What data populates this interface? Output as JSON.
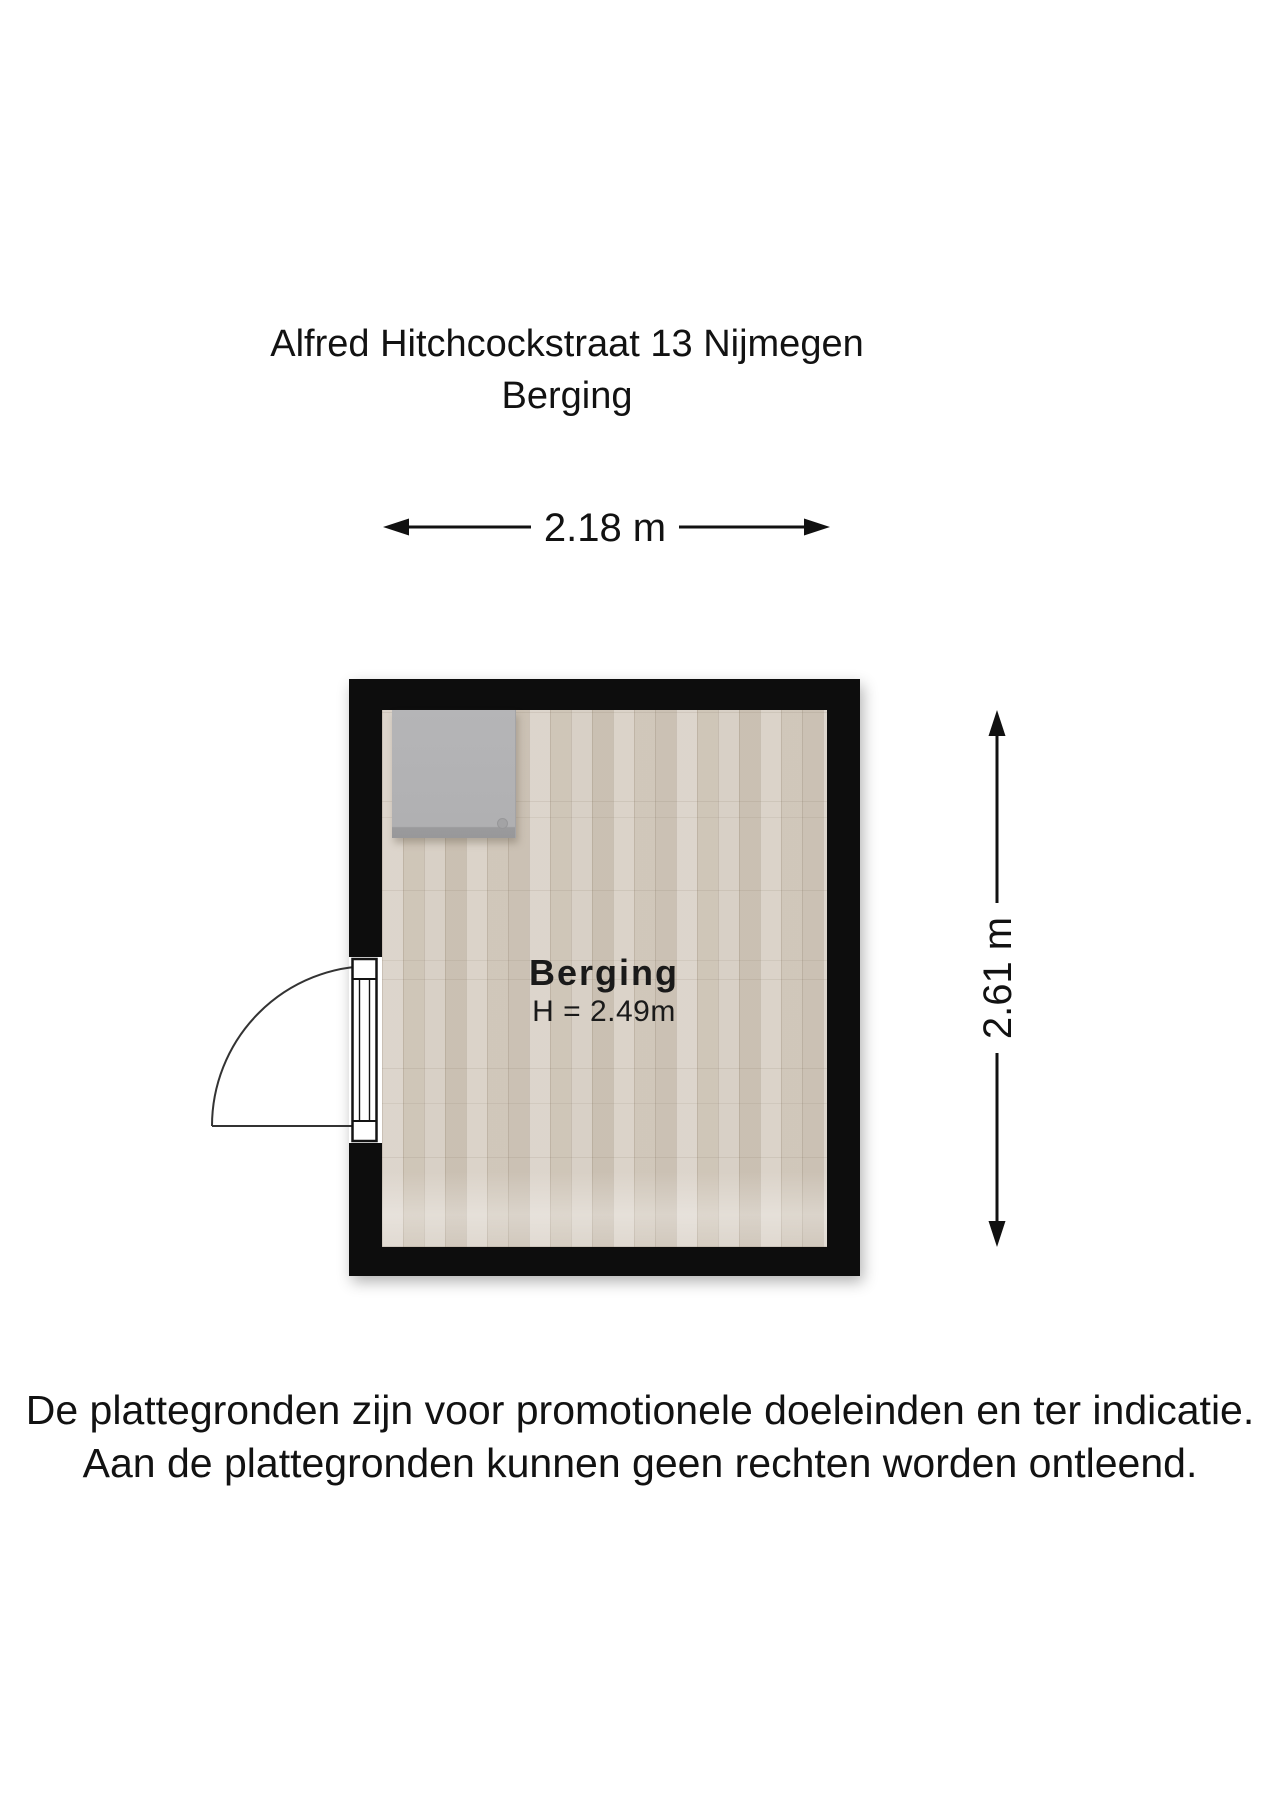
{
  "header": {
    "title_line1": "Alfred Hitchcockstraat 13 Nijmegen",
    "title_line2": "Berging"
  },
  "floorplan": {
    "room_label": "Berging",
    "ceiling_height_label": "H = 2.49m",
    "width_dimension_label": "2.18 m",
    "height_dimension_label": "2.61 m"
  },
  "footer": {
    "disclaimer_line1": "De plattegronden zijn voor promotionele doeleinden en ter indicatie.",
    "disclaimer_line2": "Aan de plattegronden kunnen geen rechten worden ontleend."
  },
  "colors": {
    "wall": "#0d0d0d",
    "floor_base": "#d4cbbf",
    "cabinet": "#b2b2b4",
    "text": "#121212"
  }
}
